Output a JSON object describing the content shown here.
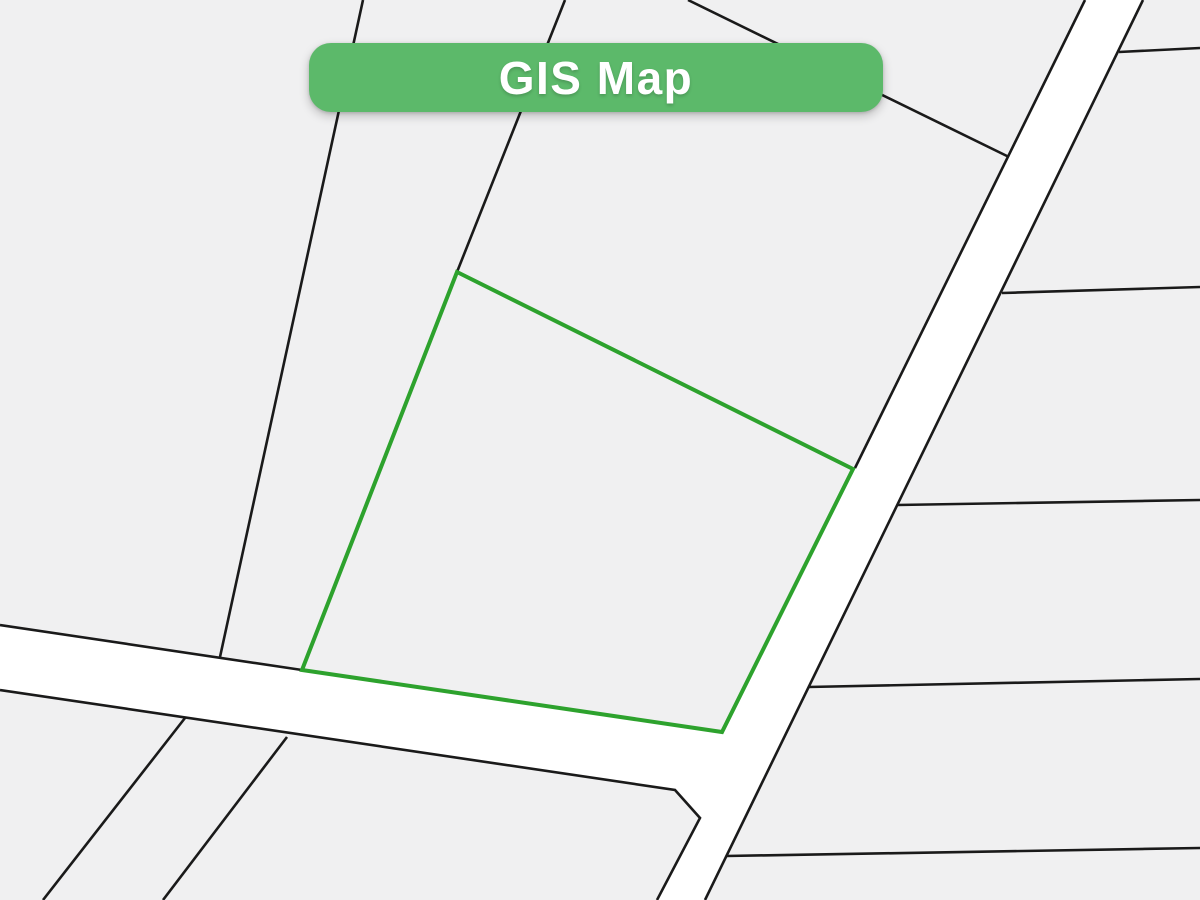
{
  "banner": {
    "label": "GIS Map",
    "bg_color": "#5cb96a",
    "text_color": "#ffffff",
    "x": 309,
    "y": 43,
    "width": 574,
    "height": 69,
    "radius": 22
  },
  "map": {
    "width": 1200,
    "height": 900,
    "background_color": "#f0f0f1",
    "road_fill_color": "#ffffff",
    "boundary_color": "#1a1a1a",
    "boundary_width": 2.6,
    "highlight_color": "#2da22d",
    "highlight_width": 4,
    "road_surface": {
      "name": "road-surface",
      "points": [
        [
          0,
          625
        ],
        [
          302,
          670
        ],
        [
          722,
          732
        ],
        [
          853,
          469
        ],
        [
          1085,
          0
        ],
        [
          1143,
          0
        ],
        [
          705,
          900
        ],
        [
          657,
          900
        ],
        [
          700,
          818
        ],
        [
          675,
          790
        ],
        [
          0,
          690
        ]
      ]
    },
    "boundary_lines": [
      {
        "name": "parcel-line-northwest",
        "points": [
          [
            363,
            0
          ],
          [
            220,
            657
          ]
        ]
      },
      {
        "name": "parcel-line-north",
        "points": [
          [
            565,
            0
          ],
          [
            457,
            272
          ]
        ]
      },
      {
        "name": "parcel-line-northeast",
        "points": [
          [
            688,
            0
          ],
          [
            1009,
            157
          ]
        ]
      },
      {
        "name": "road-left-edge",
        "points": [
          [
            1085,
            0
          ],
          [
            855,
            468
          ]
        ]
      },
      {
        "name": "road-right-edge",
        "points": [
          [
            1143,
            0
          ],
          [
            705,
            900
          ]
        ]
      },
      {
        "name": "road-upper-edge",
        "points": [
          [
            0,
            625
          ],
          [
            302,
            670
          ]
        ]
      },
      {
        "name": "road-lower-edge",
        "points": [
          [
            0,
            690
          ],
          [
            675,
            790
          ],
          [
            700,
            818
          ],
          [
            657,
            900
          ]
        ]
      },
      {
        "name": "parcel-line-east-1",
        "points": [
          [
            1119,
            52
          ],
          [
            1200,
            48
          ]
        ]
      },
      {
        "name": "parcel-line-east-2",
        "points": [
          [
            1002,
            293
          ],
          [
            1200,
            287
          ]
        ]
      },
      {
        "name": "parcel-line-east-3",
        "points": [
          [
            897,
            505
          ],
          [
            1200,
            500
          ]
        ]
      },
      {
        "name": "parcel-line-east-4",
        "points": [
          [
            808,
            687
          ],
          [
            1200,
            679
          ]
        ]
      },
      {
        "name": "parcel-line-east-5",
        "points": [
          [
            726,
            856
          ],
          [
            1200,
            848
          ]
        ]
      },
      {
        "name": "parcel-line-southwest-1",
        "points": [
          [
            185,
            718
          ],
          [
            43,
            900
          ]
        ]
      },
      {
        "name": "parcel-line-southwest-2",
        "points": [
          [
            287,
            737
          ],
          [
            163,
            900
          ]
        ]
      }
    ],
    "highlight_parcel": {
      "name": "highlighted-parcel",
      "points": [
        [
          457,
          272
        ],
        [
          853,
          469
        ],
        [
          722,
          732
        ],
        [
          302,
          670
        ]
      ]
    }
  }
}
